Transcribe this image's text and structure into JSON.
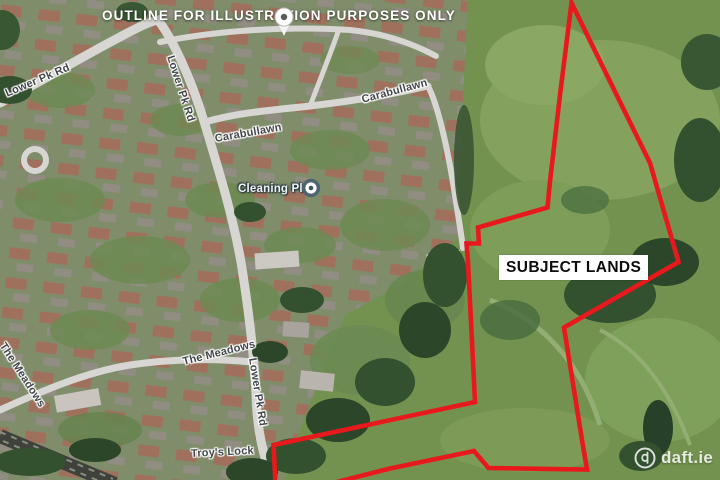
{
  "colors": {
    "outline_red": "#e8191d"
  },
  "disclaimer": {
    "text": "OUTLINE FOR ILLUSTRATION PURPOSES ONLY"
  },
  "subject": {
    "label": "SUBJECT LANDS"
  },
  "poi": {
    "label": "Cleaning Plus"
  },
  "watermark": {
    "text": "daft.ie"
  },
  "road_labels": [
    {
      "id": "lower-pk-rd-topleft",
      "text": "Lower Pk Rd"
    },
    {
      "id": "lower-pk-rd-upper",
      "text": "Lower Pk Rd"
    },
    {
      "id": "carabullawn-upper",
      "text": "Carabullawn"
    },
    {
      "id": "carabullawn-lower",
      "text": "Carabullawn"
    },
    {
      "id": "the-meadows-left",
      "text": "The Meadows"
    },
    {
      "id": "the-meadows-mid",
      "text": "The Meadows"
    },
    {
      "id": "lower-pk-rd-lower",
      "text": "Lower Pk Rd"
    },
    {
      "id": "troys-lock",
      "text": "Troy's Lock"
    }
  ]
}
